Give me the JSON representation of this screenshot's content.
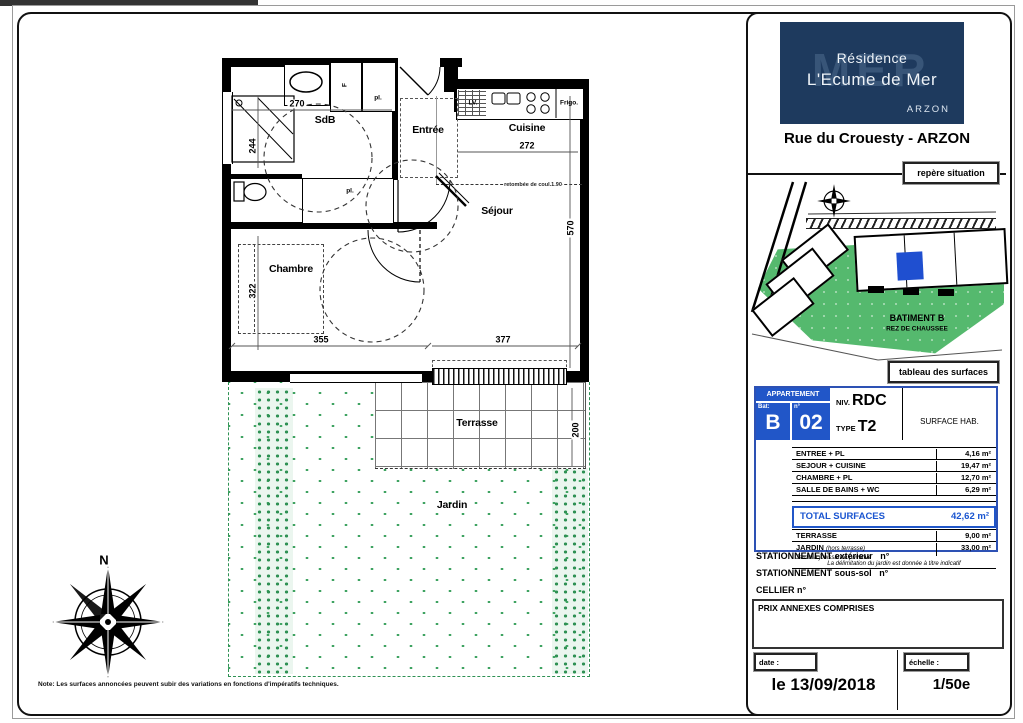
{
  "sheet": {
    "north": "N",
    "note": "Note: Les surfaces annoncées peuvent subir des variations en fonctions d'impératifs techniques."
  },
  "plan": {
    "rooms": {
      "sdb": "SdB",
      "entree": "Entrée",
      "cuisine": "Cuisine",
      "sejour": "Séjour",
      "chambre": "Chambre",
      "terrasse": "Terrasse",
      "jardin": "Jardin"
    },
    "fixtures": {
      "f": "F",
      "pl1": "pl.",
      "pl2": "pl.",
      "lv": "LV.",
      "frigo": "Frigo."
    },
    "annotation": "retombée de coul.1.90",
    "dims": {
      "sdb_w": "270",
      "sdb_h": "244",
      "cuisine_w": "272",
      "sejour_h": "570",
      "chambre_h": "322",
      "chambre_w": "355",
      "sejour_w": "377",
      "terrasse_h": "200"
    }
  },
  "title_block": {
    "logo": {
      "watermark": "MER",
      "line1": "Résidence",
      "line2": "L'Ecume de Mer",
      "city": "ARZON"
    },
    "address": "Rue du Crouesty - ARZON",
    "repere_label": "repère situation",
    "site": {
      "batiment": "BATIMENT B",
      "niveau": "REZ DE CHAUSSEE"
    },
    "tableau_label": "tableau des surfaces",
    "apartment": {
      "banner": "APPARTEMENT",
      "bat_label": "Bat:",
      "bat": "B",
      "num_label": "n°",
      "num": "02",
      "niv_label": "NIV.",
      "niv": "RDC",
      "type_label": "TYPE",
      "type": "T2",
      "surface_header": "SURFACE HAB."
    },
    "rows": [
      {
        "label": "ENTREE + PL",
        "value": "4,16 m²"
      },
      {
        "label": "SEJOUR + CUISINE",
        "value": "19,47 m²"
      },
      {
        "label": "CHAMBRE + PL",
        "value": "12,70 m²"
      },
      {
        "label": "SALLE DE BAINS + WC",
        "value": "6,29 m²"
      }
    ],
    "total": {
      "label": "TOTAL SURFACES",
      "value": "42,62 m²"
    },
    "annex_rows": [
      {
        "label": "TERRASSE",
        "note": "",
        "value": "9,00 m²"
      },
      {
        "label": "JARDIN",
        "note": "(hors terrasse)",
        "value": "33,00 m²"
      }
    ],
    "table_notes": [
      "Jardin à jouissance privative",
      "La délimitation du jardin est donnée à titre indicatif"
    ],
    "parking_ext": "STATIONNEMENT extérieur",
    "parking_ext_n": "n°",
    "parking_ss": "STATIONNEMENT sous-sol",
    "parking_ss_n": "n°",
    "cellier": "CELLIER n°",
    "prix": "PRIX ANNEXES COMPRISES",
    "date_label": "date :",
    "date_value": "le 13/09/2018",
    "scale_label": "échelle :",
    "scale_value": "1/50e"
  },
  "colors": {
    "navy": "#1e3a5e",
    "table_blue": "#2156c8",
    "total_blue": "#1a55d0",
    "site_green": "#55b96e",
    "jardin_green": "#3fa361",
    "unit_blue": "#1f4fd0"
  }
}
